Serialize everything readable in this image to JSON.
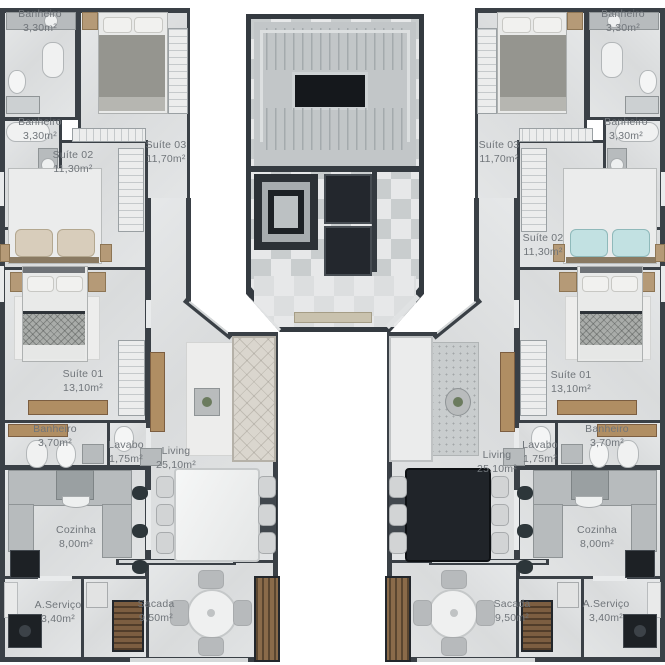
{
  "plan": {
    "title": "Planta do pavimento - duas unidades espelhadas",
    "palette": {
      "wall": "#3a4046",
      "floor": "#dfe1e2",
      "core_floor": "#c7cbcd",
      "wood": "#b08e63",
      "label_text": "#70757a",
      "background": "#ffffff"
    },
    "units": {
      "left": {
        "rooms": [
          {
            "name": "Banheiro",
            "area": "3,30m²"
          },
          {
            "name": "Banheiro",
            "area": "3,30m²"
          },
          {
            "name": "Suíte 02",
            "area": "11,30m²"
          },
          {
            "name": "Suíte 03",
            "area": "11,70m²"
          },
          {
            "name": "Suíte 01",
            "area": "13,10m²"
          },
          {
            "name": "Banheiro",
            "area": "3,70m²"
          },
          {
            "name": "Lavabo",
            "area": "1,75m²"
          },
          {
            "name": "Living",
            "area": "25,10m²"
          },
          {
            "name": "Cozinha",
            "area": "8,00m²"
          },
          {
            "name": "A.Serviço",
            "area": "3,40m²"
          },
          {
            "name": "Sacada",
            "area": "9,50m²"
          }
        ]
      },
      "right": {
        "rooms": [
          {
            "name": "Banheiro",
            "area": "3,30m²"
          },
          {
            "name": "Banheiro",
            "area": "3,30m²"
          },
          {
            "name": "Suíte 02",
            "area": "11,30m²"
          },
          {
            "name": "Suíte 03",
            "area": "11,70m²"
          },
          {
            "name": "Suíte 01",
            "area": "13,10m²"
          },
          {
            "name": "Banheiro",
            "area": "3,70m²"
          },
          {
            "name": "Lavabo",
            "area": "1,75m²"
          },
          {
            "name": "Living",
            "area": "25,10m²"
          },
          {
            "name": "Cozinha",
            "area": "8,00m²"
          },
          {
            "name": "A.Serviço",
            "area": "3,40m²"
          },
          {
            "name": "Sacada",
            "area": "9,50m²"
          }
        ]
      }
    }
  }
}
